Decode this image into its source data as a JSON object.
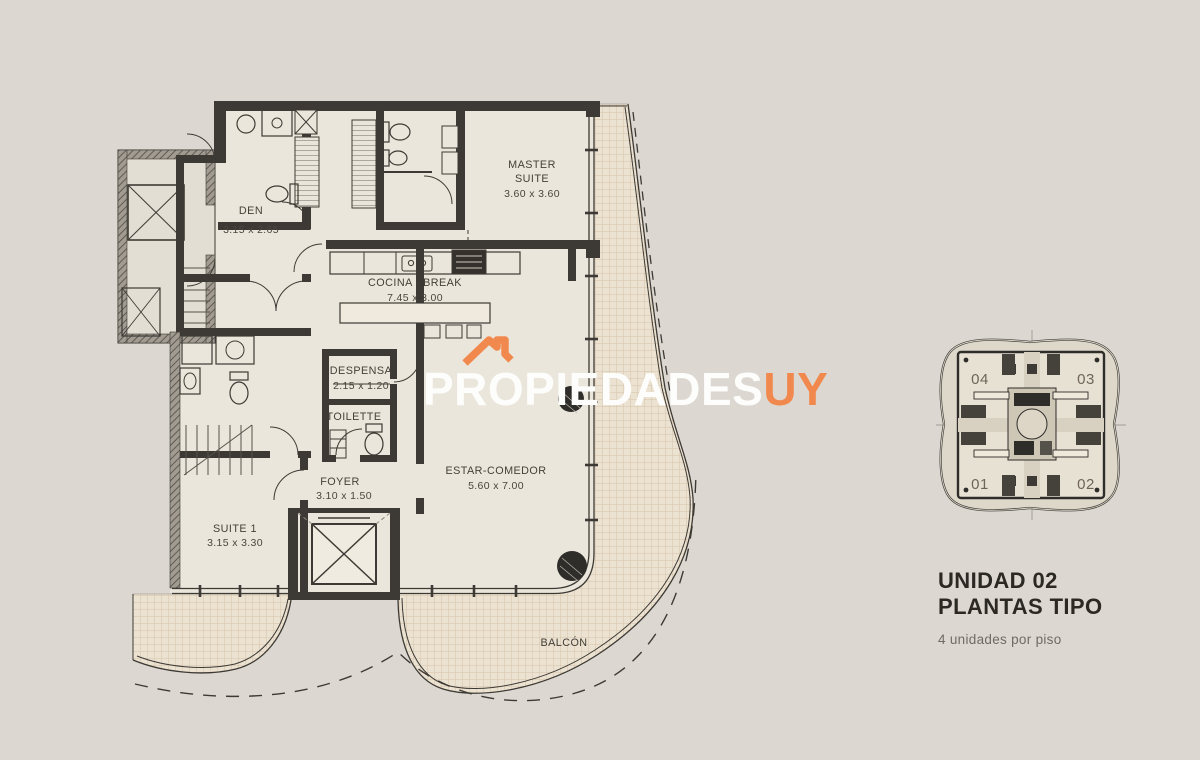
{
  "colors": {
    "background": "#dcd8d1",
    "floor": "#eae6db",
    "wall": "#3d3a35",
    "accent_orange": "#f1894e",
    "balcony_grid_line": "#d6c3ac"
  },
  "watermark": {
    "brand": "PROPIEDADES",
    "suffix": "UY",
    "icon": "roof-icon"
  },
  "floorplan": {
    "rooms": {
      "den": {
        "label": "DEN",
        "dims": "3.15 x 2.65"
      },
      "master": {
        "label_line1": "MASTER",
        "label_line2": "SUITE",
        "dims": "3.60 x 3.60"
      },
      "cocina": {
        "label": "COCINA - BREAK",
        "dims": "7.45 x 3.00"
      },
      "despensa": {
        "label": "DESPENSA",
        "dims": "2.15 x 1.20"
      },
      "toilette": {
        "label": "TOILETTE"
      },
      "foyer": {
        "label": "FOYER",
        "dims": "3.10 x 1.50"
      },
      "estar": {
        "label": "ESTAR-COMEDOR",
        "dims": "5.60 x 7.00"
      },
      "suite1": {
        "label": "SUITE 1",
        "dims": "3.15 x 3.30"
      },
      "balcon": {
        "label": "BALCÓN"
      }
    }
  },
  "keyplan": {
    "units": {
      "top_left": "04",
      "top_right": "03",
      "bottom_left": "01",
      "bottom_right": "02"
    },
    "highlighted_unit": "02"
  },
  "panel": {
    "title_line1": "UNIDAD 02",
    "title_line2": "PLANTAS TIPO",
    "subtitle": "4 unidades por piso"
  }
}
